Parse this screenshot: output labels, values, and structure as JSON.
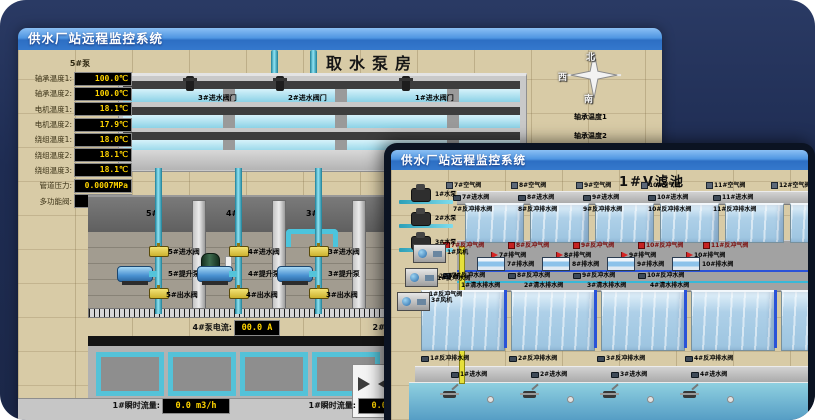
{
  "colors": {
    "titlebar_top": "#8cc0f4",
    "titlebar_bottom": "#3579cd",
    "background_navy": "#1e2c52",
    "led_text": "#ffd400",
    "pipe_cyan": "#4cc4dc",
    "valve_yellow": "#e8d23c",
    "alarm_red": "#c42222"
  },
  "back_window": {
    "title": "供水厂站远程监控系统",
    "scene_title": "取水泵房",
    "pump_panel": {
      "header": "5#泵",
      "rows": [
        {
          "label": "轴承温度1:",
          "value": "100.0℃"
        },
        {
          "label": "轴承温度2:",
          "value": "100.0℃"
        },
        {
          "label": "电机温度1:",
          "value": "18.1℃"
        },
        {
          "label": "电机温度2:",
          "value": "17.9℃"
        },
        {
          "label": "绕组温度1:",
          "value": "18.0℃"
        },
        {
          "label": "绕组温度2:",
          "value": "18.1℃"
        },
        {
          "label": "绕组温度3:",
          "value": "18.1℃"
        },
        {
          "label": "管道压力:",
          "value": "0.0007MPa"
        },
        {
          "label": "多功能阀:",
          "value": "0%"
        }
      ]
    },
    "intake_valve_labels": [
      "3#进水阀门",
      "2#进水阀门",
      "1#进水阀门"
    ],
    "compass": {
      "north": "北",
      "west": "西",
      "south": "南"
    },
    "right_edge_labels": [
      "轴承温度1",
      "轴承温度2"
    ],
    "bay_numbers": [
      "5#",
      "4#",
      "3#",
      "2#"
    ],
    "pump_bays": [
      {
        "inlet": "5#进水阀",
        "pump": "5#提升泵",
        "outlet": "5#出水阀"
      },
      {
        "inlet": "4#进水阀",
        "pump": "4#提升泵",
        "outlet": "4#出水阀"
      },
      {
        "inlet": "3#进水阀",
        "pump": "3#提升泵",
        "outlet": "3#出水阀"
      }
    ],
    "current_meters": [
      {
        "label": "4#泵电流:",
        "value": "00.0 A"
      },
      {
        "label": "2#泵电流:",
        "value": ""
      }
    ],
    "flow_meters": [
      {
        "label": "1#瞬时流量:",
        "value": "0.0 m3/h"
      },
      {
        "label": "1#瞬时流量:",
        "value": "0.0 m3/h"
      }
    ]
  },
  "front_window": {
    "title": "供水厂站远程监控系统",
    "scene_title": "1#V滤池",
    "top_air_valves": [
      "7#空气阀",
      "8#空气阀",
      "9#空气阀",
      "10#空气阀",
      "11#空气阀",
      "12#空气阀"
    ],
    "top_inlet_valves": [
      "7#进水阀",
      "8#进水阀",
      "9#进水阀",
      "10#进水阀",
      "11#进水阀"
    ],
    "top_drain_valves": [
      "7#反冲排水阀",
      "8#反冲排水阀",
      "9#反冲排水阀",
      "10#反冲排水阀",
      "11#反冲排水阀"
    ],
    "backwash_air_valves": [
      "7#反冲气阀",
      "8#反冲气阀",
      "9#反冲气阀",
      "10#反冲气阀",
      "11#反冲气阀"
    ],
    "exhaust_valves": [
      "7#排气阀",
      "8#排气阀",
      "9#排气阀",
      "10#排气阀"
    ],
    "drain_small_valves": [
      "7#排水阀",
      "8#排水阀",
      "9#排水阀",
      "10#排水阀"
    ],
    "backwash_water_valves": [
      "7#反冲水阀",
      "8#反冲水阀",
      "9#反冲水阀",
      "10#反冲水阀"
    ],
    "clear_drain_valves": [
      "1#清水排水阀",
      "2#清水排水阀",
      "3#清水排水阀",
      "4#清水排水阀"
    ],
    "bottom_drain_valves": [
      "1#反冲排水阀",
      "2#反冲排水阀",
      "3#反冲排水阀",
      "4#反冲排水阀"
    ],
    "bottom_inlet_valves": [
      "1#进水阀",
      "2#进水阀",
      "3#进水阀",
      "4#进水阀"
    ],
    "pumps": [
      "1#水泵",
      "2#水泵",
      "3#水泵"
    ],
    "blowers": [
      "1#风机",
      "2#风机",
      "3#风机"
    ],
    "pipe_labels": [
      "1#反冲水阀",
      "1#反冲气阀"
    ]
  }
}
